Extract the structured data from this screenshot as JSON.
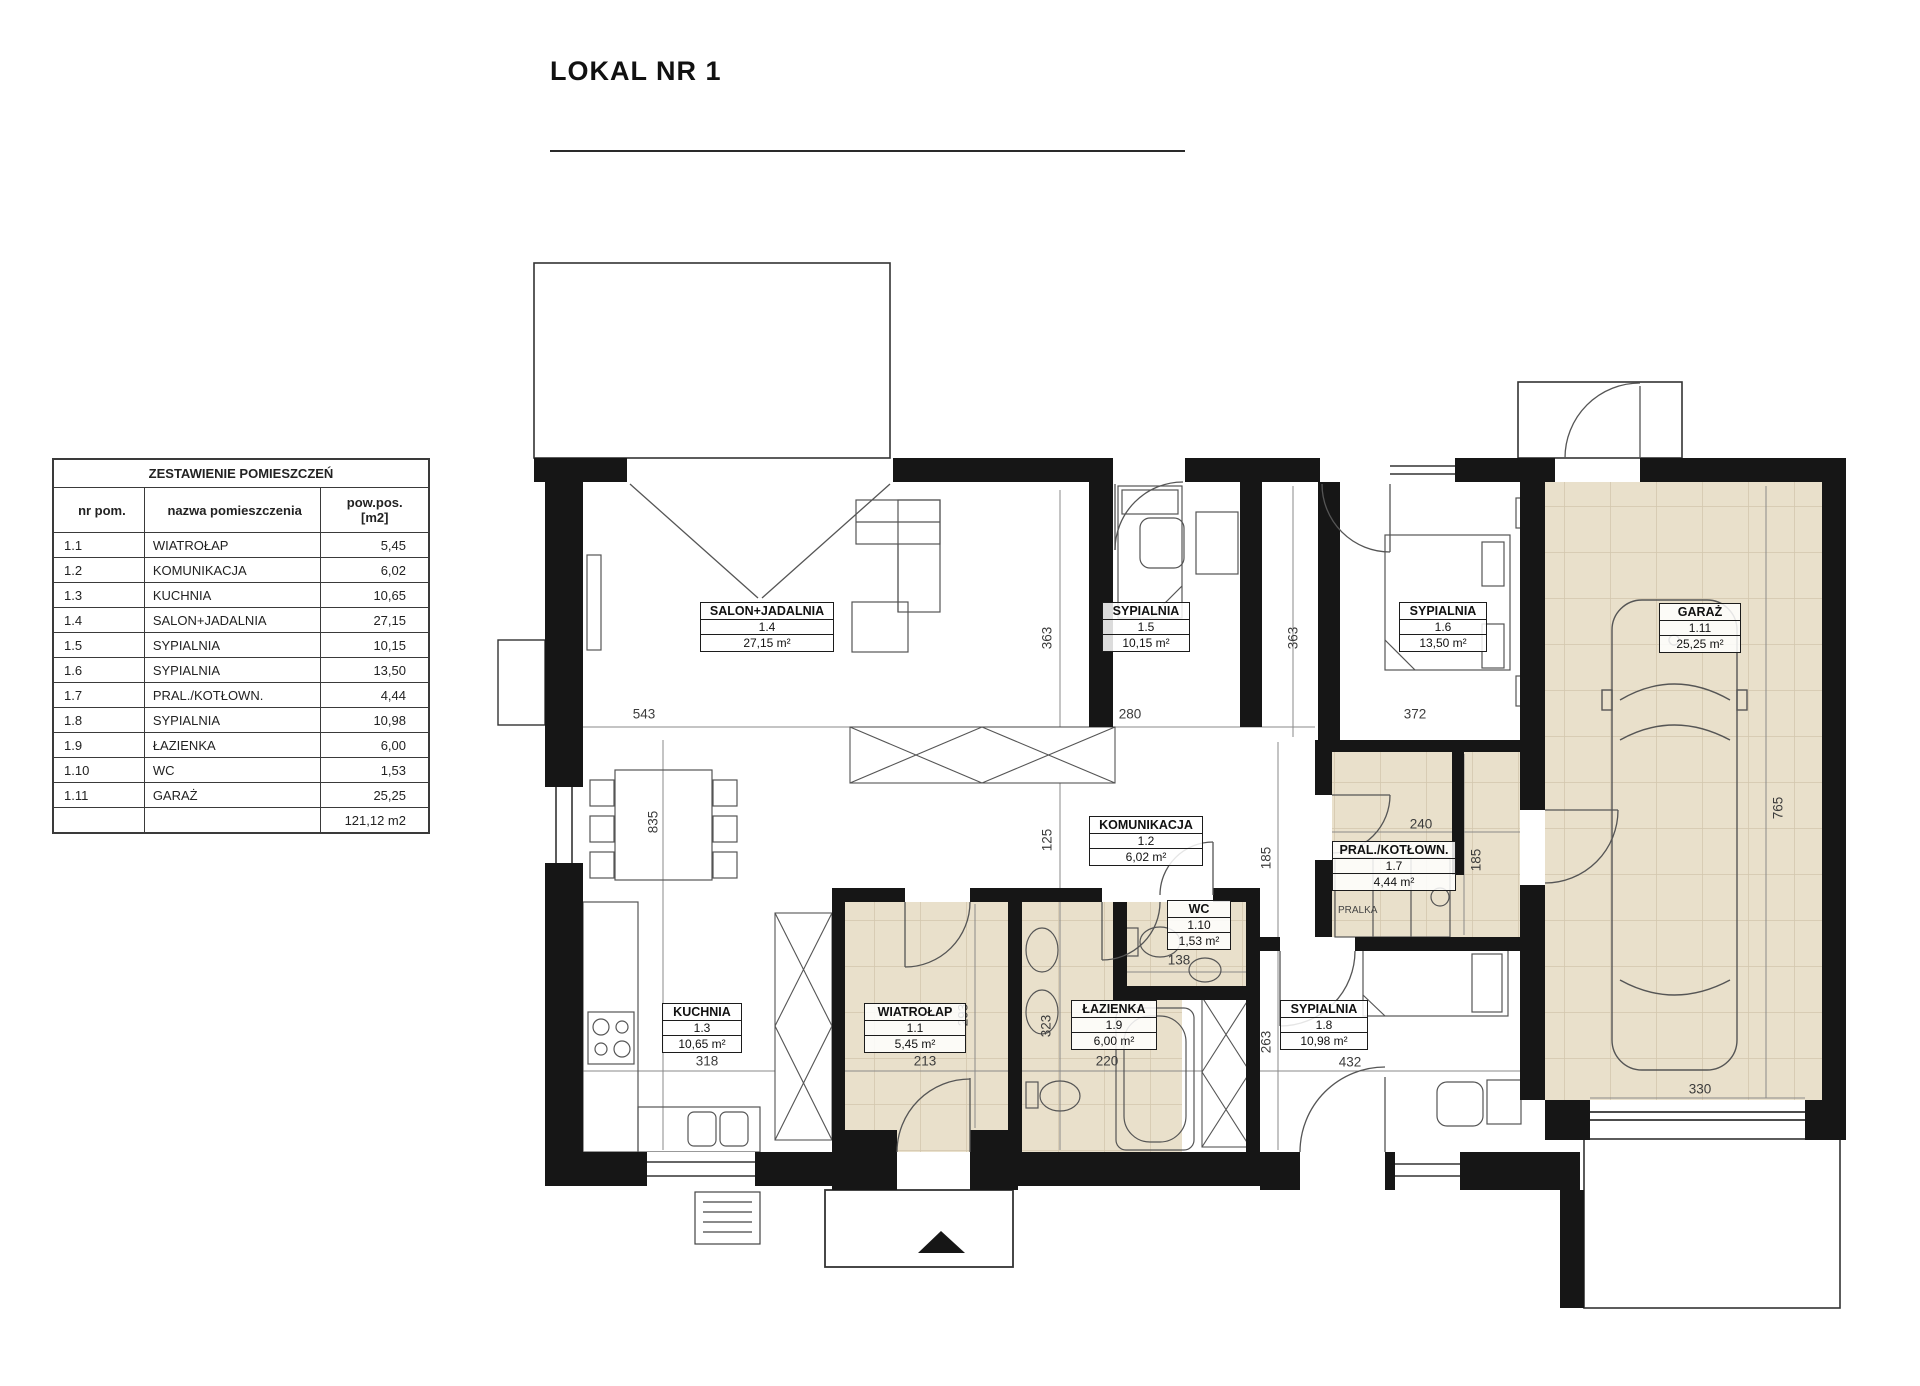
{
  "title": "LOKAL NR 1",
  "schedule_table": {
    "title": "ZESTAWIENIE POMIESZCZEŃ",
    "headers": {
      "nr": "nr pom.",
      "name": "nazwa pomieszczenia",
      "area_line1": "pow.pos.",
      "area_line2": "[m2]"
    },
    "rows": [
      {
        "nr": "1.1",
        "name": "WIATROŁAP",
        "area": "5,45"
      },
      {
        "nr": "1.2",
        "name": "KOMUNIKACJA",
        "area": "6,02"
      },
      {
        "nr": "1.3",
        "name": "KUCHNIA",
        "area": "10,65"
      },
      {
        "nr": "1.4",
        "name": "SALON+JADALNIA",
        "area": "27,15"
      },
      {
        "nr": "1.5",
        "name": "SYPIALNIA",
        "area": "10,15"
      },
      {
        "nr": "1.6",
        "name": "SYPIALNIA",
        "area": "13,50"
      },
      {
        "nr": "1.7",
        "name": "PRAL./KOTŁOWN.",
        "area": "4,44"
      },
      {
        "nr": "1.8",
        "name": "SYPIALNIA",
        "area": "10,98"
      },
      {
        "nr": "1.9",
        "name": "ŁAZIENKA",
        "area": "6,00"
      },
      {
        "nr": "1.10",
        "name": "WC",
        "area": "1,53"
      },
      {
        "nr": "1.11",
        "name": "GARAŻ",
        "area": "25,25"
      }
    ],
    "total": "121,12 m2"
  },
  "room_labels": [
    {
      "name": "WIATROŁAP",
      "number": "1.1",
      "area": "5,45 m²"
    },
    {
      "name": "KOMUNIKACJA",
      "number": "1.2",
      "area": "6,02 m²"
    },
    {
      "name": "KUCHNIA",
      "number": "1.3",
      "area": "10,65 m²"
    },
    {
      "name": "SALON+JADALNIA",
      "number": "1.4",
      "area": "27,15 m²"
    },
    {
      "name": "SYPIALNIA",
      "number": "1.5",
      "area": "10,15 m²"
    },
    {
      "name": "SYPIALNIA",
      "number": "1.6",
      "area": "13,50 m²"
    },
    {
      "name": "PRAL./KOTŁOWN.",
      "number": "1.7",
      "area": "4,44 m²"
    },
    {
      "name": "SYPIALNIA",
      "number": "1.8",
      "area": "10,98 m²"
    },
    {
      "name": "ŁAZIENKA",
      "number": "1.9",
      "area": "6,00 m²"
    },
    {
      "name": "WC",
      "number": "1.10",
      "area": "1,53 m²"
    },
    {
      "name": "GARAŻ",
      "number": "1.11",
      "area": "25,25 m²"
    }
  ],
  "dimensions": {
    "salon_width": "543",
    "syp15_width": "280",
    "syp16_width": "372",
    "salon_height": "835",
    "syp15_height": "363",
    "syp16_height": "363",
    "hall_125": "125",
    "hall_185": "185",
    "pral_185": "185",
    "pral_width": "240",
    "garage_width": "330",
    "garage_height": "765",
    "kitchen_width": "318",
    "wiatrolap_width": "213",
    "wiatrolap_height": "293",
    "lazienka_width": "220",
    "lazienka_height": "323",
    "wc_width": "138",
    "syp18_width": "432",
    "syp18_height": "263"
  },
  "annotations": {
    "washer": "PRALKA"
  },
  "colors": {
    "wall": "#161616",
    "floor_tile": "#e9e0cb",
    "tile_line": "#d2c6ad",
    "line": "#4a4a4a"
  }
}
